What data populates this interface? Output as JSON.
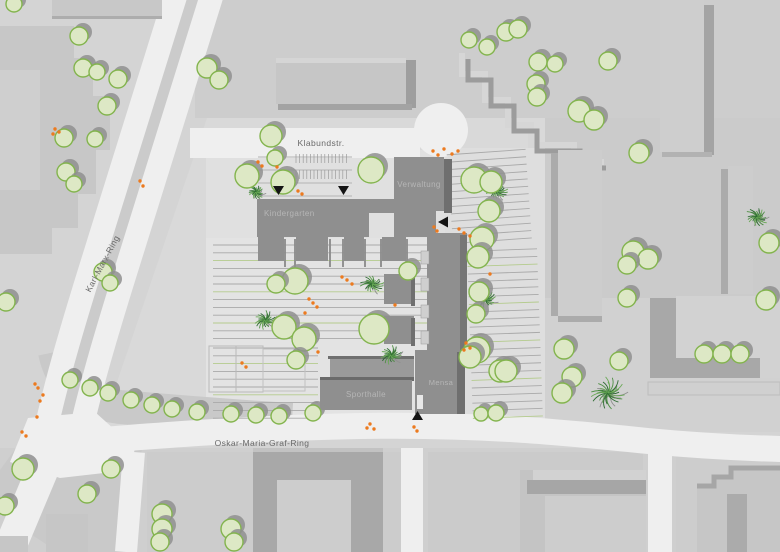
{
  "map": {
    "streets": {
      "klabundstr": "Klabundstr.",
      "karl_marx_ring": "Karl-Marx-Ring",
      "oskar_maria_graf_ring": "Oskar-Maria-Graf-Ring"
    },
    "buildings": {
      "verwaltung": "Verwaltung",
      "kindergarten": "Kindergarten",
      "sporthalle": "Sporthalle",
      "mensa": "Mensa"
    }
  },
  "colors": {
    "tree_fill": "#dde8c5",
    "tree_stroke": "#83b44e",
    "tree_shadow": "#8f8f8f",
    "bush_dark": "#2f6b33",
    "bush_mid": "#4e8f44",
    "bush_light": "#69a855",
    "bush_shadow": "#909090",
    "people_dot": "#ec7a1f",
    "marker": "#141414",
    "street_label": "#6a6a6a",
    "building_label": "#b6b6b6",
    "school_building": "#8f8f8f",
    "school_dark_face": "#6f6f6f"
  },
  "features": {
    "trees": [
      [
        14,
        4,
        8
      ],
      [
        79,
        36,
        9
      ],
      [
        83,
        68,
        9
      ],
      [
        97,
        72,
        8
      ],
      [
        118,
        79,
        9
      ],
      [
        107,
        106,
        9
      ],
      [
        64,
        138,
        9
      ],
      [
        95,
        139,
        8
      ],
      [
        66,
        172,
        9
      ],
      [
        74,
        184,
        8
      ],
      [
        103,
        272,
        9
      ],
      [
        110,
        283,
        8
      ],
      [
        6,
        302,
        9
      ],
      [
        207,
        68,
        10
      ],
      [
        219,
        80,
        9
      ],
      [
        271,
        136,
        11
      ],
      [
        275,
        158,
        8
      ],
      [
        247,
        176,
        12
      ],
      [
        283,
        182,
        12
      ],
      [
        371,
        170,
        13
      ],
      [
        469,
        40,
        8
      ],
      [
        487,
        47,
        8
      ],
      [
        506,
        32,
        9
      ],
      [
        518,
        29,
        9
      ],
      [
        538,
        62,
        9
      ],
      [
        555,
        64,
        8
      ],
      [
        536,
        84,
        9
      ],
      [
        537,
        97,
        9
      ],
      [
        579,
        111,
        11
      ],
      [
        594,
        120,
        10
      ],
      [
        608,
        61,
        9
      ],
      [
        639,
        153,
        10
      ],
      [
        474,
        180,
        13
      ],
      [
        491,
        182,
        11
      ],
      [
        489,
        211,
        11
      ],
      [
        482,
        239,
        12
      ],
      [
        478,
        257,
        11
      ],
      [
        479,
        292,
        10
      ],
      [
        476,
        314,
        9
      ],
      [
        477,
        350,
        13
      ],
      [
        500,
        371,
        11
      ],
      [
        408,
        271,
        9
      ],
      [
        295,
        281,
        13
      ],
      [
        276,
        284,
        9
      ],
      [
        284,
        327,
        12
      ],
      [
        304,
        339,
        12
      ],
      [
        374,
        329,
        15
      ],
      [
        296,
        360,
        9
      ],
      [
        633,
        252,
        11
      ],
      [
        648,
        259,
        10
      ],
      [
        627,
        265,
        9
      ],
      [
        627,
        298,
        9
      ],
      [
        564,
        349,
        10
      ],
      [
        619,
        361,
        9
      ],
      [
        572,
        377,
        10
      ],
      [
        562,
        393,
        10
      ],
      [
        704,
        354,
        9
      ],
      [
        722,
        354,
        9
      ],
      [
        740,
        354,
        9
      ],
      [
        766,
        300,
        10
      ],
      [
        769,
        243,
        10
      ],
      [
        70,
        380,
        8
      ],
      [
        90,
        388,
        8
      ],
      [
        108,
        393,
        8
      ],
      [
        131,
        400,
        8
      ],
      [
        152,
        405,
        8
      ],
      [
        172,
        409,
        8
      ],
      [
        197,
        412,
        8
      ],
      [
        231,
        414,
        8
      ],
      [
        256,
        415,
        8
      ],
      [
        279,
        416,
        8
      ],
      [
        313,
        413,
        8
      ],
      [
        470,
        357,
        11
      ],
      [
        506,
        371,
        11
      ],
      [
        481,
        414,
        7
      ],
      [
        496,
        413,
        8
      ],
      [
        23,
        469,
        11
      ],
      [
        5,
        506,
        9
      ],
      [
        111,
        469,
        9
      ],
      [
        87,
        494,
        9
      ],
      [
        162,
        514,
        10
      ],
      [
        162,
        529,
        10
      ],
      [
        160,
        542,
        9
      ],
      [
        231,
        529,
        10
      ],
      [
        234,
        542,
        9
      ]
    ],
    "bushes": [
      [
        256,
        192,
        9
      ],
      [
        265,
        320,
        12
      ],
      [
        372,
        284,
        12
      ],
      [
        391,
        355,
        12
      ],
      [
        486,
        299,
        11
      ],
      [
        497,
        191,
        11
      ],
      [
        608,
        393,
        20
      ],
      [
        757,
        217,
        12
      ]
    ],
    "people_dots": [
      [
        55,
        129
      ],
      [
        59,
        132
      ],
      [
        53,
        134
      ],
      [
        140,
        181
      ],
      [
        143,
        186
      ],
      [
        258,
        162
      ],
      [
        262,
        166
      ],
      [
        277,
        167
      ],
      [
        298,
        191
      ],
      [
        302,
        194
      ],
      [
        433,
        151
      ],
      [
        438,
        155
      ],
      [
        444,
        149
      ],
      [
        452,
        154
      ],
      [
        458,
        151
      ],
      [
        434,
        227
      ],
      [
        437,
        231
      ],
      [
        459,
        229
      ],
      [
        464,
        233
      ],
      [
        470,
        236
      ],
      [
        490,
        274
      ],
      [
        466,
        343
      ],
      [
        470,
        348
      ],
      [
        464,
        350
      ],
      [
        347,
        280
      ],
      [
        352,
        284
      ],
      [
        342,
        277
      ],
      [
        309,
        299
      ],
      [
        313,
        303
      ],
      [
        317,
        307
      ],
      [
        305,
        313
      ],
      [
        395,
        305
      ],
      [
        242,
        363
      ],
      [
        246,
        367
      ],
      [
        318,
        352
      ],
      [
        370,
        424
      ],
      [
        374,
        429
      ],
      [
        367,
        428
      ],
      [
        414,
        427
      ],
      [
        417,
        431
      ],
      [
        38,
        388
      ],
      [
        43,
        395
      ],
      [
        40,
        401
      ],
      [
        35,
        384
      ],
      [
        22,
        432
      ],
      [
        26,
        436
      ],
      [
        37,
        417
      ]
    ],
    "entrance_markers": [
      {
        "x": 278.5,
        "y": 190,
        "dir": "down"
      },
      {
        "x": 343.5,
        "y": 190,
        "dir": "down"
      },
      {
        "x": 443,
        "y": 222,
        "dir": "left"
      },
      {
        "x": 417.5,
        "y": 415,
        "dir": "up"
      }
    ]
  }
}
